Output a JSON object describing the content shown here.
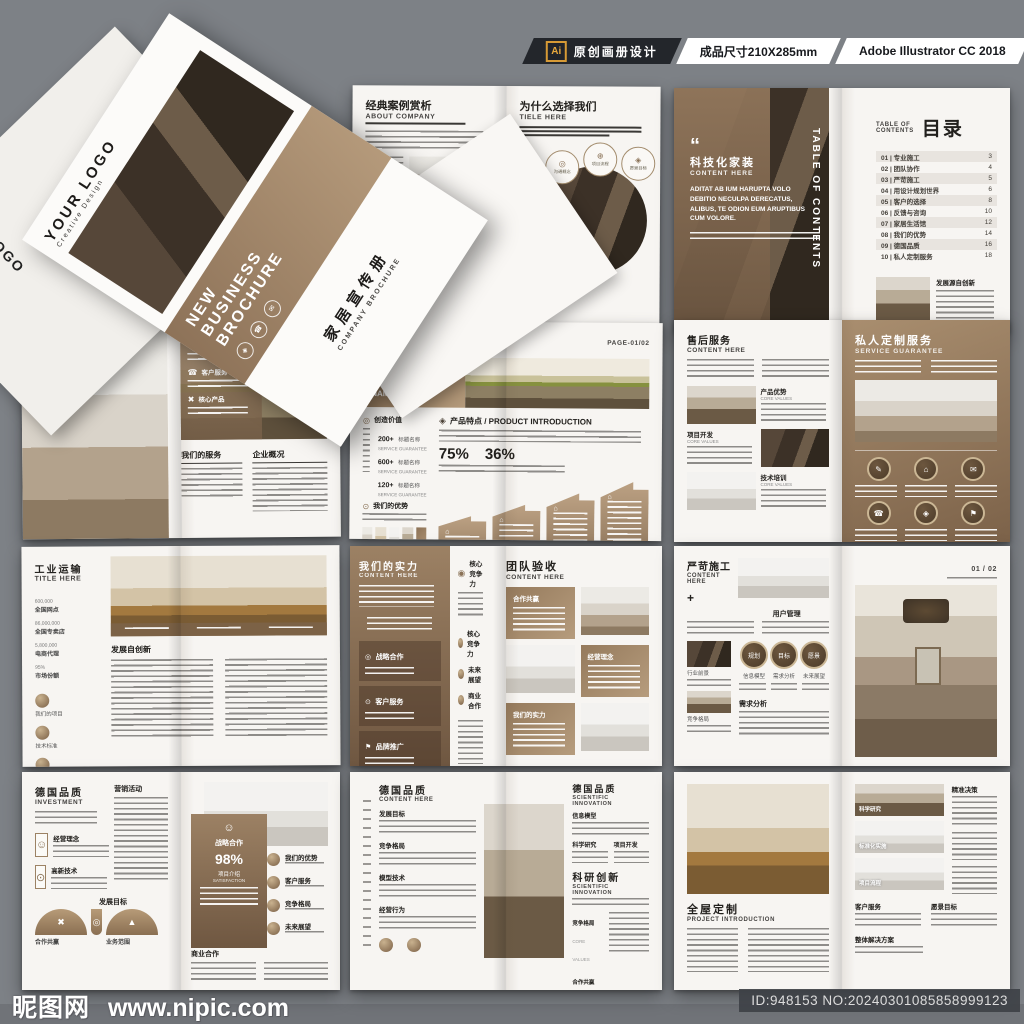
{
  "banner": {
    "ai_badge": "Ai",
    "label_design": "原创画册设计",
    "label_size": "成品尺寸210X285mm",
    "label_software": "Adobe Illustrator CC 2018"
  },
  "watermark": {
    "site_cn": "昵图网",
    "site_url": "www.nipic.com",
    "id_text": "ID:948153 NO:20240301085858999123"
  },
  "icons": {
    "diamond": "◈",
    "phone": "☎",
    "mail": "✉",
    "target": "◎",
    "plus": "⊕",
    "cross": "✖",
    "dotc": "⊙",
    "triangle": "▲",
    "house": "⌂",
    "pencil": "✎",
    "person": "☺",
    "flag": "⚑",
    "bigdot": "◉",
    "quote": "“",
    "star": "★"
  },
  "cover": {
    "logo": "YOUR LOGO",
    "logo_sub": "Creative Design",
    "band_line1": "NEW",
    "band_line2": "BUSINESS",
    "band_line3": "BROCHURE",
    "title_cn": "家居宣传册",
    "title_en": "COMPANY BROCHURE",
    "hotline_label": "全国统一服务热线",
    "hotline_number": "400-123-4567"
  },
  "s1": {
    "left": {
      "title": "经典案例赏析",
      "sub": "ABOUT COMPANY"
    },
    "right": {
      "title": "为什么选择我们",
      "sub": "TIELE HERE",
      "badges": [
        "沟通概念",
        "项目流程",
        "愿景目标",
        "市场分析",
        "竞争格局",
        "设计方针"
      ]
    }
  },
  "s2": {
    "left": {
      "title": "科技化家装",
      "sub": "CONTENT HERE",
      "body": "ADITAT AB IUM HARUPTA VOLO DEBITIO NECULPA DERECATUS, ALIBUS, TE ODION EUM ARUPTIBUS CUM VOLORE.",
      "spine": "TABLE OF CONTENTS"
    },
    "right": {
      "toc_label1": "TABLE OF",
      "toc_label2": "CONTENTS",
      "toc_title": "目录",
      "items": [
        {
          "label": "01 | 专业施工",
          "page": "3"
        },
        {
          "label": "02 | 团队协作",
          "page": "4"
        },
        {
          "label": "03 | 严苛施工",
          "page": "5"
        },
        {
          "label": "04 | 用设计规划世界",
          "page": "6"
        },
        {
          "label": "05 | 客户的选择",
          "page": "8"
        },
        {
          "label": "06 | 反馈与咨询",
          "page": "10"
        },
        {
          "label": "07 | 家居生活馆",
          "page": "12"
        },
        {
          "label": "08 | 我们的优势",
          "page": "14"
        },
        {
          "label": "09 | 德国品质",
          "page": "16"
        },
        {
          "label": "10 | 私人定制服务",
          "page": "18"
        }
      ],
      "feature_title": "发展源自创新"
    }
  },
  "s3": {
    "left": {
      "title": "精英设计师",
      "sub": "CONTENT HERE"
    },
    "right": {
      "services": [
        "优质服务",
        "客户服务",
        "核心产品"
      ],
      "col1": "我们的服务",
      "col2": "企业概况"
    }
  },
  "s4": {
    "brand": "BRAND",
    "page_no": "PAGE-01/02",
    "banner_title": "关于环保",
    "banner_sub1": "PRODUCT",
    "banner_sub2": "NAME",
    "sec1": "创造价值",
    "sec2": "我们的优势",
    "stats": [
      {
        "v": "200+",
        "l": "标题名称",
        "e": "SERVICE GUARANTEE"
      },
      {
        "v": "600+",
        "l": "标题名称",
        "e": "SERVICE GUARANTEE"
      },
      {
        "v": "120+",
        "l": "标题名称",
        "e": "SERVICE GUARANTEE"
      }
    ],
    "thumbs": [
      "生物科技",
      "新能源",
      "房地产",
      "信息科技",
      "医疗"
    ],
    "right_title": "产品特点 / PRODUCT INTRODUCTION",
    "pct1": "75%",
    "pct2": "36%"
  },
  "s5": {
    "left": {
      "title": "售后服务",
      "sub": "CONTENT HERE",
      "cells": [
        {
          "t": "产品优势",
          "e": "CORE VALUES"
        },
        {
          "t": "项目开发",
          "e": "CORE VALUES"
        },
        {
          "t": "技术培训",
          "e": "CORE VALUES"
        }
      ]
    },
    "right": {
      "title": "私人定制服务",
      "sub": "SERVICE GUARANTEE"
    }
  },
  "s6": {
    "title": "工业运输",
    "sub": "TITLE HERE",
    "stats": [
      {
        "v": "600,000",
        "l": "全国网点"
      },
      {
        "v": "86,000,000",
        "l": "全国专卖店"
      },
      {
        "v": "5,800,000",
        "l": "电商代理"
      },
      {
        "v": "95%",
        "l": "市场份额"
      }
    ],
    "icons": [
      "我们的项目",
      "技术标准",
      "产品优势"
    ],
    "section": "发展自创新"
  },
  "s7": {
    "left": {
      "title": "我们的实力",
      "sub": "CONTENT HERE",
      "boxes": [
        "战略合作",
        "客户服务",
        "品牌推广"
      ],
      "list": [
        "核心竞争力",
        "核心竞争力",
        "未来展望",
        "商业合作"
      ]
    },
    "right": {
      "title": "团队验收",
      "sub": "CONTENT HERE",
      "bubbles": [
        "合作共赢",
        "经营理念",
        "我们的实力"
      ]
    }
  },
  "s8": {
    "left": {
      "title": "严苛施工",
      "sub": "CONTENT HERE",
      "plus": "+",
      "sec1": "用户管理",
      "side": [
        "行业前景",
        "竞争格局"
      ],
      "circles": [
        "规划",
        "目标",
        "愿景"
      ],
      "circle_labels": [
        "信息模型",
        "需求分析",
        "未来展望"
      ],
      "sec2": "需求分析"
    },
    "right": {
      "page_no": "01 / 02"
    }
  },
  "s9": {
    "left": {
      "title": "德国品质",
      "sub": "INVESTMENT",
      "col_title": "营销活动",
      "sq": [
        "经营理念",
        "高新技术"
      ],
      "sec": "发展目标",
      "arc1": "合作共赢",
      "arc2": "业务范围"
    },
    "right": {
      "panel_title": "战略合作",
      "pct": "98%",
      "panel_sub1": "项目介绍",
      "panel_sub2": "SATISFACTION",
      "list": [
        "我们的优势",
        "客户服务",
        "竞争格局",
        "未来展望"
      ],
      "bottom": "商业合作"
    }
  },
  "s10": {
    "left": {
      "title": "德国品质",
      "sub": "CONTENT HERE",
      "secs": [
        "发展目标",
        "竞争格局",
        "模型技术",
        "经营行为"
      ]
    },
    "right": {
      "title": "德国品质",
      "sub": "SCIENTIFIC INNOVATION",
      "sec1": "信息模型",
      "sec2": "科学研究",
      "sec3": "项目开发",
      "big_title": "科研创新",
      "big_sub": "SCIENTIFIC INNOVATION",
      "rows": [
        {
          "t": "竞争格局",
          "e": "CORE VALUES"
        },
        {
          "t": "合作共赢",
          "e": "OUR MISSION"
        },
        {
          "t": "竞争格局",
          "e": "CORE VALUES"
        }
      ]
    }
  },
  "s11": {
    "left": {
      "title": "全屋定制",
      "sub": "PROJECT INTRODUCTION"
    },
    "right": {
      "thumbs": [
        "科学研究",
        "标准化实施",
        "项目流程"
      ],
      "side_title": "精准决策",
      "head1": "客户服务",
      "head2": "愿景目标",
      "bottom": "整体解决方案"
    }
  }
}
